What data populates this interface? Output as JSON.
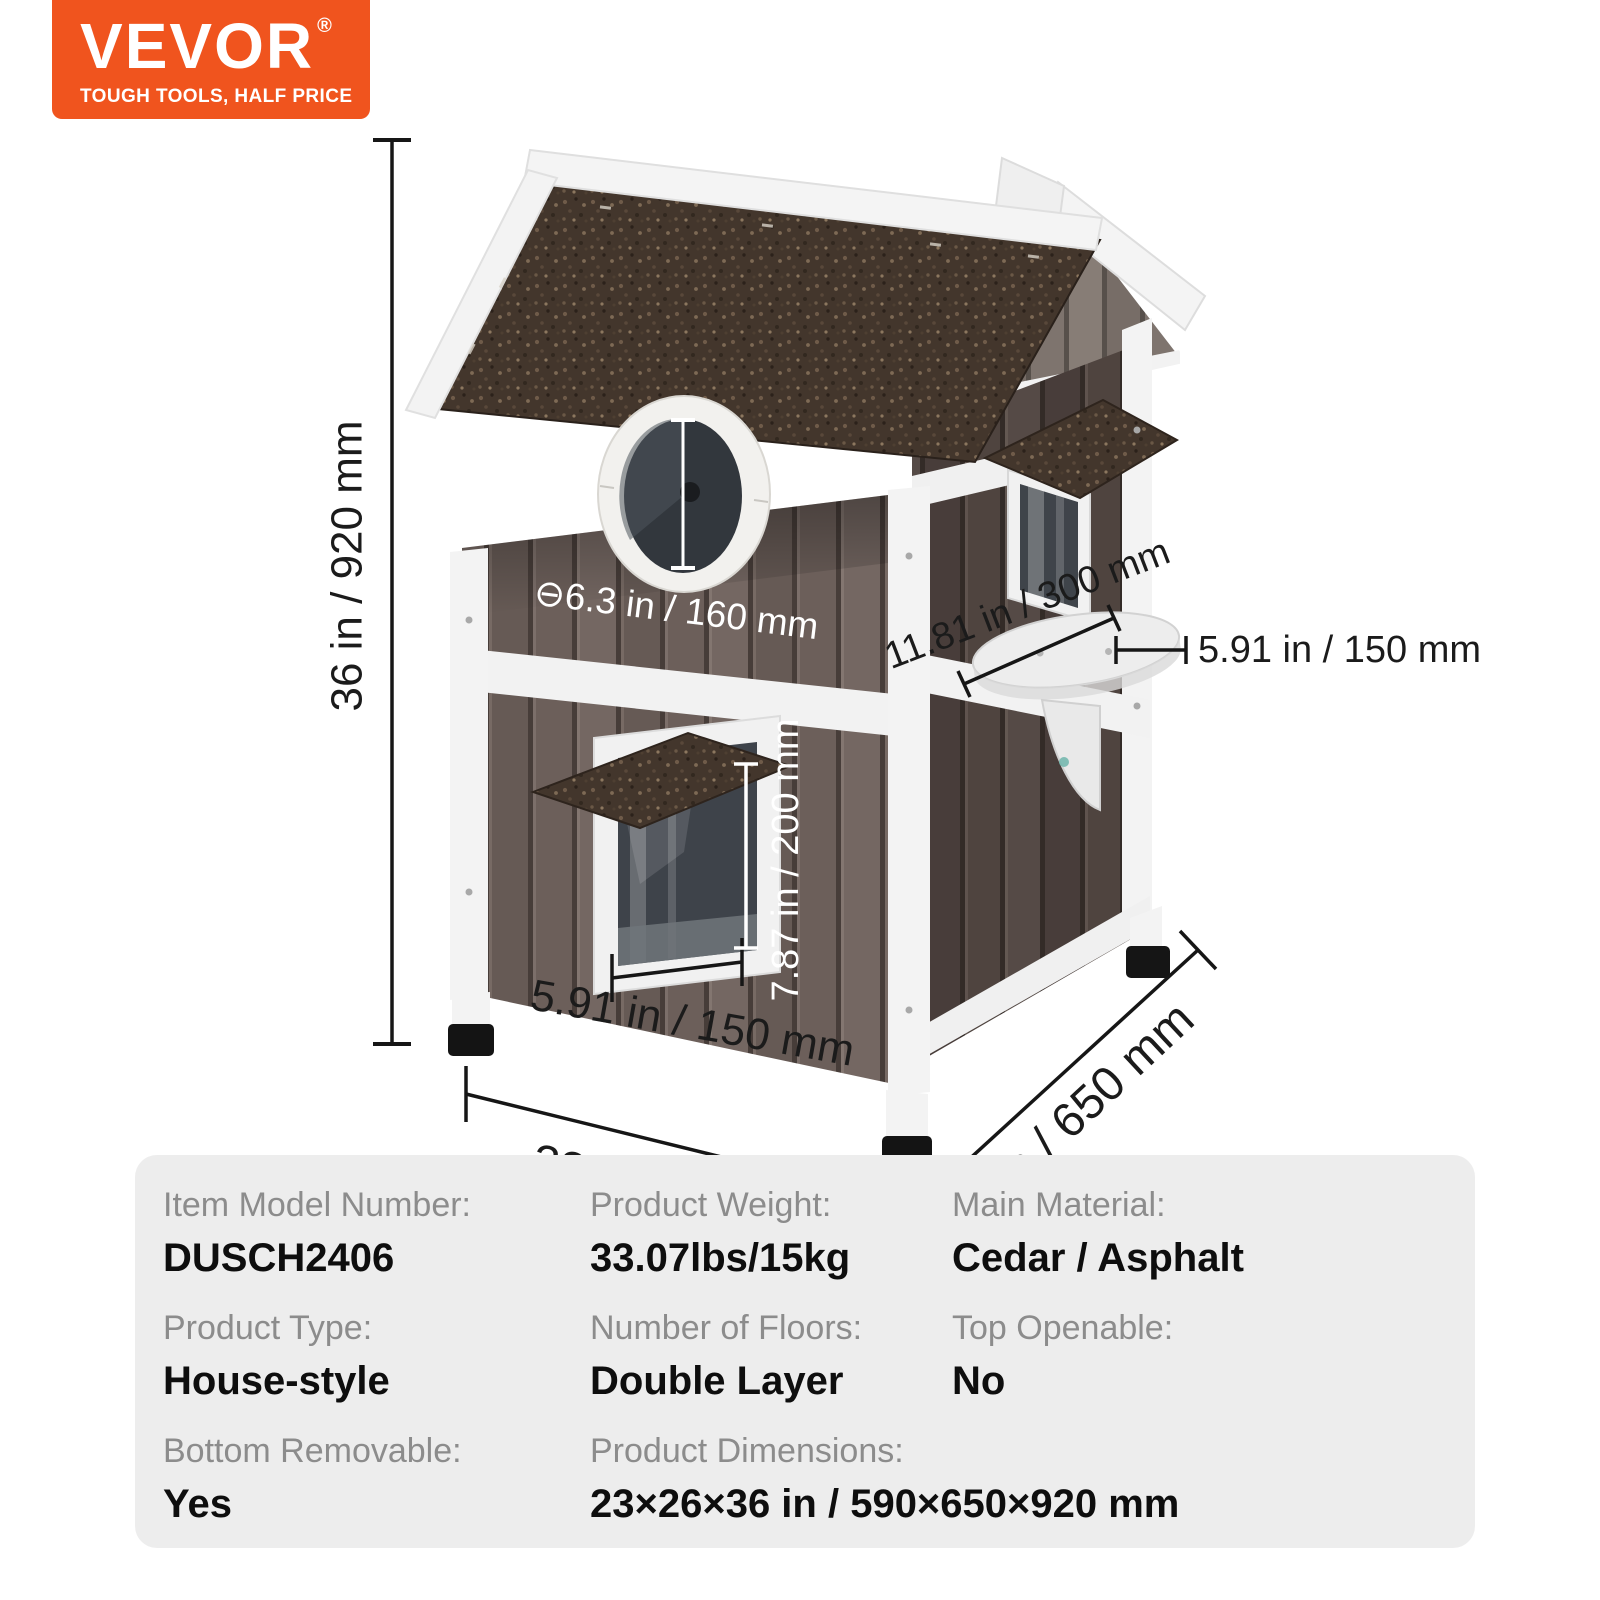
{
  "logo": {
    "brand": "VEVOR",
    "registered_mark": "®",
    "tagline": "TOUGH TOOLS, HALF PRICE",
    "bg_color": "#F0541E"
  },
  "diagram": {
    "overall_height": "36 in / 920 mm",
    "window_diameter": "⊖6.3 in / 160 mm",
    "side_window_width": "11.81 in / 300 mm",
    "perch_depth": "5.91 in / 150 mm",
    "door_height": "7.87 in / 200 mm",
    "door_width": "5.91 in / 150 mm",
    "base_width": "23 in / 590 mm",
    "base_depth": "26 in / 650 mm"
  },
  "specs": {
    "rows": [
      [
        {
          "label": "Item Model Number:",
          "value": "DUSCH2406"
        },
        {
          "label": "Product Weight:",
          "value": "33.07lbs/15kg"
        },
        {
          "label": "Main Material:",
          "value": "Cedar / Asphalt"
        }
      ],
      [
        {
          "label": "Product Type:",
          "value": "House-style"
        },
        {
          "label": "Number of Floors:",
          "value": "Double Layer"
        },
        {
          "label": "Top Openable:",
          "value": "No"
        }
      ],
      [
        {
          "label": "Bottom Removable:",
          "value": "Yes"
        },
        {
          "label": "Product Dimensions:",
          "value": "23×26×36 in / 590×650×920 mm"
        }
      ]
    ]
  },
  "colors": {
    "brand_orange": "#F0541E",
    "table_bg": "#EDEDED",
    "spec_label_gray": "#8C8C8C",
    "spec_value_black": "#0E0E0E",
    "asphalt_brown": "#43362C",
    "wood_brown": "#6C5F5A",
    "trim_white": "#F2F2F2",
    "dimension_line": "#161616"
  }
}
